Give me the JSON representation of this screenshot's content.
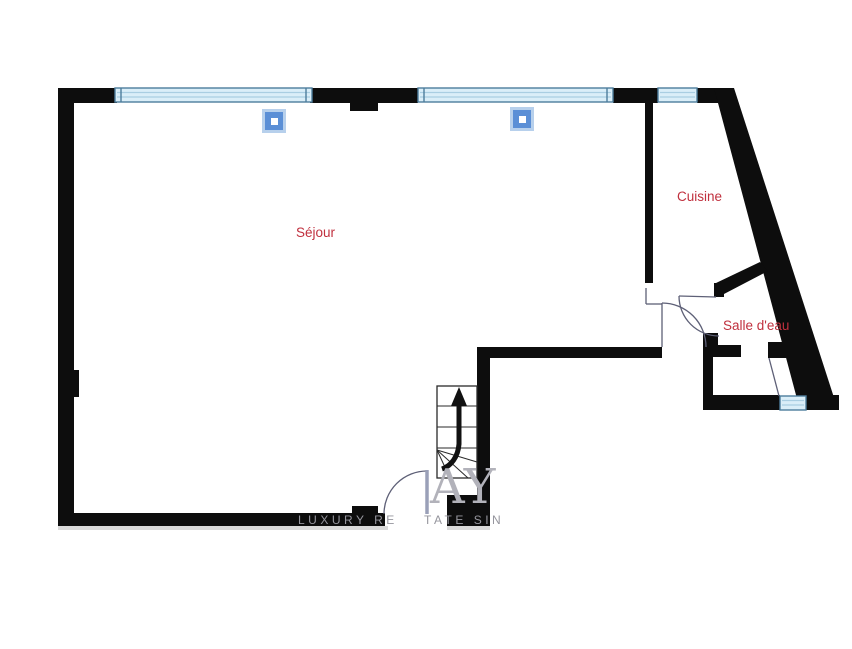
{
  "plan": {
    "rooms": [
      {
        "id": "sejour",
        "label": "Séjour"
      },
      {
        "id": "cuisine",
        "label": "Cuisine"
      },
      {
        "id": "salle-deau",
        "label": "Salle d'eau"
      }
    ],
    "stairs": {
      "arrow_direction": "up"
    },
    "windows_count": 4,
    "columns_count": 2
  },
  "watermark": {
    "monogram": "AY",
    "caption_left": "LUXURY RE",
    "caption_right": "TATE SIN"
  },
  "colors": {
    "bg": "#ffffff",
    "wall": "#0d0d0d",
    "room-label": "#c0303e",
    "win-fill": "#daeef8",
    "win-frame": "#4d7d9c",
    "win-inner": "#a9cee2",
    "col-halo": "#b7d0ec",
    "col-blue": "#5b8fd6",
    "door": "#5e6077",
    "leaf": "#9aa0b8",
    "mark": "#b2b2ba",
    "caption": "#95959d",
    "shadow": "#c6c6c6",
    "stair-line": "#2a2a2a",
    "arrow": "#111111"
  }
}
